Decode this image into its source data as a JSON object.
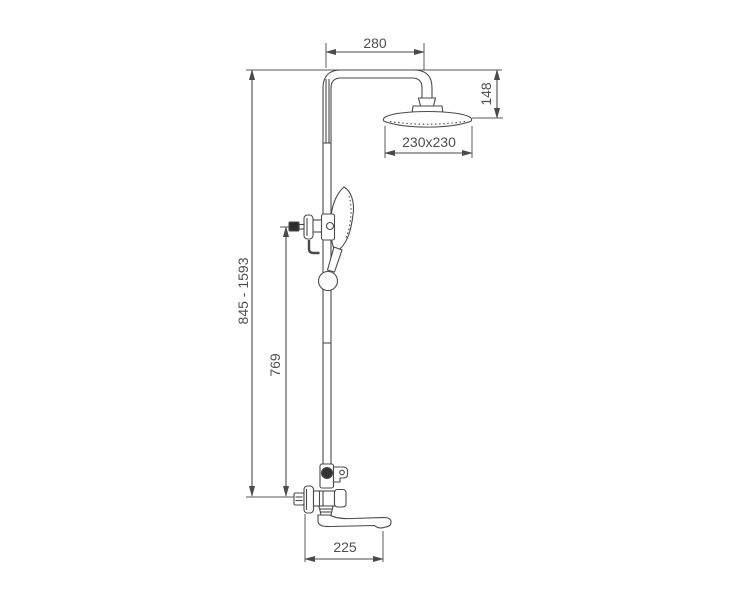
{
  "drawing": {
    "title": "shower-column-technical-drawing",
    "dimensions": {
      "horizontal_reach": "280",
      "head_drop_height": "148",
      "head_size": "230x230",
      "overall_height_range": "845 - 1593",
      "handshower_holder_height": "769",
      "spout_reach": "225"
    },
    "colors": {
      "line": "#4a4a4a",
      "text": "#4f4f4f",
      "fill_dark": "#333333",
      "background": "#ffffff"
    }
  }
}
